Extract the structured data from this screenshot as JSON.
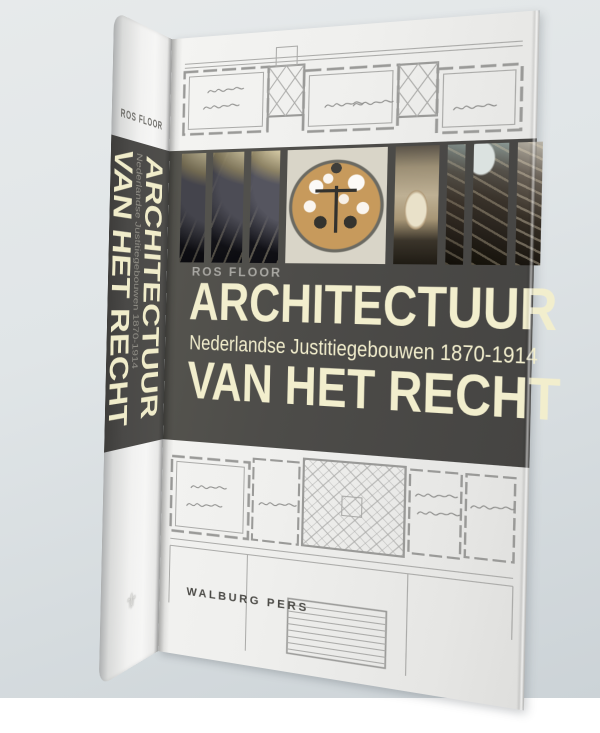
{
  "book": {
    "spine": {
      "author": "ROS FLOOR",
      "title_line1": "ARCHITECTUUR",
      "subtitle": "Nederlandse Justitiegebouwen 1870-1914",
      "title_line2": "VAN HET RECHT",
      "publisher_logo_glyph": "⚜"
    },
    "front": {
      "author": "ROS FLOOR",
      "title_line1": "ARCHITECTUUR",
      "subtitle": "Nederlandse Justitiegebouwen 1870-1914",
      "title_line2": "VAN HET RECHT",
      "publisher": "WALBURG PERS",
      "photos": [
        {
          "name": "courtroom-gallery-photo-strip-1",
          "css": "ph-gal"
        },
        {
          "name": "courtroom-gallery-photo-strip-2",
          "css": "ph-gal ph-gal2 ph-gal2b"
        },
        {
          "name": "courtroom-gallery-photo-strip-3",
          "css": "ph-gal ph-gal3 ph-gal3b"
        },
        {
          "name": "stained-glass-scales-of-justice-photo",
          "css": "ph-stained"
        },
        {
          "name": "corridor-arch-photo",
          "css": "ph-corridor"
        },
        {
          "name": "staircase-photo-strip-1",
          "css": "ph-stair-n"
        },
        {
          "name": "staircase-photo-strip-2",
          "css": "ph-stair"
        },
        {
          "name": "staircase-photo-strip-3",
          "css": "ph-stair-r"
        }
      ]
    },
    "colors": {
      "band": "#4c4b49",
      "title_text": "#f2eecd",
      "paper": "#efefed",
      "author_label": "#a7a6a1",
      "publisher_text": "#4b4a46",
      "background_top": "#e7eaeb",
      "background_bottom": "#ccd3d7"
    }
  }
}
